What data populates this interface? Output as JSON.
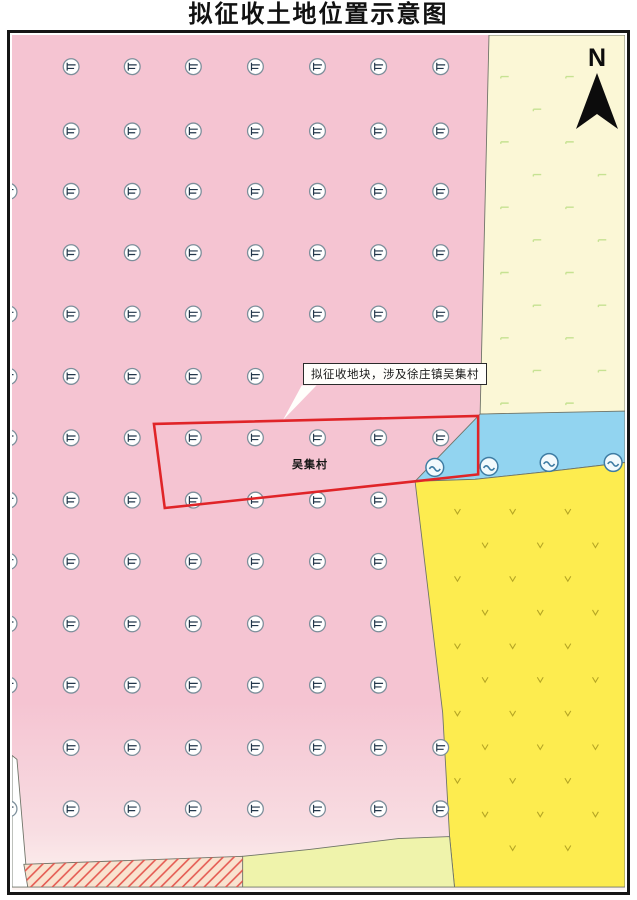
{
  "page": {
    "title": "拟征收土地位置示意图"
  },
  "map": {
    "north_label": "N",
    "callout_text": "拟征收地块，涉及徐庄镇吴集村",
    "parcel_label": "吴集村",
    "colors": {
      "pink_land": "#f5c4d2",
      "pink_fade": "#fdf3f0",
      "cream_land": "#fbf7d6",
      "water_blue": "#92d4f0",
      "yellow_land": "#fdec4f",
      "pale_green_land": "#eff3ab",
      "hatch_bg": "#f9e2cf",
      "hatch_line": "#e4574f",
      "boundary_line": "#6f7468",
      "red_parcel_line": "#e02428",
      "land_symbol_ring": "#7d8f9b",
      "land_symbol_glyph": "#22364a",
      "pond_stroke": "#3e7ca3",
      "pond_fill": "#f2fafd",
      "cream_tick": "#c6e292",
      "yellow_tick": "#b5a524"
    },
    "geometry": {
      "view": [
        622,
        864
      ],
      "regions": {
        "white_wedge": [
          [
            0,
            728
          ],
          [
            5,
            732
          ],
          [
            16,
            861
          ],
          [
            0,
            861
          ]
        ],
        "cream": [
          [
            484,
            0
          ],
          [
            622,
            0
          ],
          [
            622,
            381
          ],
          [
            475,
            383
          ]
        ],
        "blue": [
          [
            475,
            383
          ],
          [
            622,
            380
          ],
          [
            622,
            432
          ],
          [
            545,
            441
          ],
          [
            470,
            449
          ],
          [
            409,
            451
          ]
        ],
        "yellow": [
          [
            409,
            451
          ],
          [
            470,
            449
          ],
          [
            545,
            441
          ],
          [
            622,
            432
          ],
          [
            622,
            861
          ],
          [
            449,
            861
          ],
          [
            444,
            810
          ],
          [
            437,
            685
          ]
        ],
        "pale_green": [
          [
            234,
            830
          ],
          [
            302,
            823
          ],
          [
            392,
            812
          ],
          [
            444,
            810
          ],
          [
            449,
            861
          ],
          [
            234,
            861
          ]
        ],
        "hatch": [
          [
            12,
            838
          ],
          [
            234,
            830
          ],
          [
            234,
            861
          ],
          [
            16,
            861
          ]
        ]
      },
      "yellow_left_boundary": [
        [
          409,
          451
        ],
        [
          437,
          685
        ],
        [
          444,
          810
        ],
        [
          449,
          861
        ]
      ],
      "red_polygon": [
        [
          144,
          393
        ],
        [
          473,
          385
        ],
        [
          473,
          444
        ],
        [
          409,
          451
        ],
        [
          155,
          478
        ]
      ],
      "callout_tail": [
        [
          294,
          354
        ],
        [
          309,
          354
        ],
        [
          275,
          389
        ]
      ],
      "ponds": [
        [
          429,
          437
        ],
        [
          484,
          436
        ],
        [
          545,
          432
        ],
        [
          610,
          432
        ]
      ],
      "land_symbol_cols": [
        -3,
        60,
        122,
        184,
        247,
        310,
        372,
        435
      ],
      "land_symbol_rows": [
        {
          "y": 32,
          "c": [
            1,
            2,
            3,
            4,
            5,
            6,
            7
          ]
        },
        {
          "y": 97,
          "c": [
            1,
            2,
            3,
            4,
            5,
            6,
            7
          ]
        },
        {
          "y": 158,
          "c": [
            0,
            1,
            2,
            3,
            4,
            5,
            6,
            7
          ]
        },
        {
          "y": 220,
          "c": [
            1,
            2,
            3,
            4,
            5,
            6,
            7
          ]
        },
        {
          "y": 282,
          "c": [
            0,
            1,
            2,
            3,
            4,
            5,
            6,
            7
          ]
        },
        {
          "y": 345,
          "c": [
            0,
            1,
            2,
            3,
            4,
            5,
            6,
            7
          ]
        },
        {
          "y": 407,
          "c": [
            0,
            1,
            2,
            3,
            4,
            5,
            6,
            7
          ]
        },
        {
          "y": 470,
          "c": [
            0,
            1,
            2,
            3,
            4,
            5,
            6
          ]
        },
        {
          "y": 532,
          "c": [
            0,
            1,
            2,
            3,
            4,
            5,
            6
          ]
        },
        {
          "y": 595,
          "c": [
            0,
            1,
            2,
            3,
            4,
            5,
            6
          ]
        },
        {
          "y": 657,
          "c": [
            0,
            1,
            2,
            3,
            4,
            5,
            6
          ]
        },
        {
          "y": 720,
          "c": [
            1,
            2,
            3,
            4,
            5,
            6,
            7
          ]
        },
        {
          "y": 782,
          "c": [
            0,
            1,
            2,
            3,
            4,
            5,
            6,
            7
          ]
        }
      ],
      "cream_ticks": {
        "y0": 42,
        "dy": 33,
        "rows": 11,
        "x0": 500,
        "alt": 33,
        "dx": 66,
        "xmax": 610
      },
      "yellow_ticks": {
        "y0": 482,
        "dy": 34,
        "rows": 11,
        "x0": 452,
        "alt": 28,
        "dx": 56,
        "xmax": 612
      }
    }
  }
}
